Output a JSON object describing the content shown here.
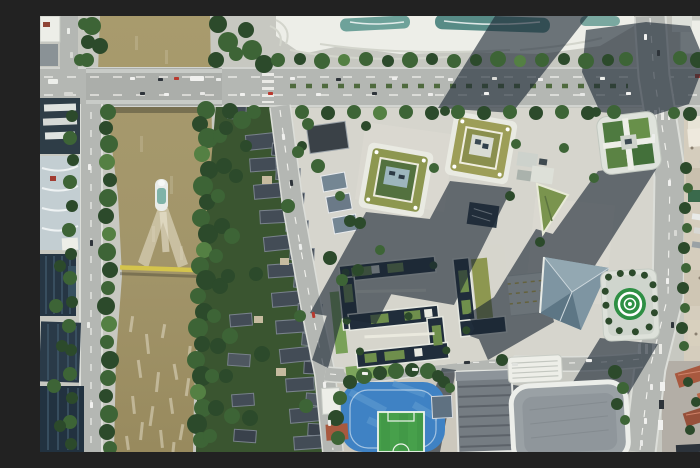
{
  "meta": {
    "domain": "aerial-photograph",
    "description": "Top-down aerial drone photograph of a riverside urban district: a khaki-colored canal on the left with a boat leaving a white V wake, a gray road bridge crossing it at top and a thin yellow footbridge lower down, tree-lined banks, a historic quarter of dark tiled rooftops east of the canal, a wide tree-lined boulevard across the top, modern square office towers with olive-green roof gardens casting long diagonal shadows to the southwest, a glass pyramid hall, a rooftop circular green helipad, a zigzag dark-glass low-rise complex, a blue running track with green soccer pitch at bottom center, large gray-roofed halls at bottom right, a construction yard along the right edge and red-roofed housing in the southeast corner.",
    "width_px": 700,
    "height_px": 436,
    "visible_text": "none"
  },
  "landmarks": [
    {
      "name": "canal",
      "note": "khaki-brown water, choppy white texture at bottom"
    },
    {
      "name": "boat-with-wake",
      "note": "small white boat heading north, V-shaped foam wake"
    },
    {
      "name": "road-bridge",
      "note": "gray multi-lane bridge with vehicles"
    },
    {
      "name": "yellow-footbridge",
      "note": "thin yellow span across canal"
    },
    {
      "name": "historic-rooftop-quarter",
      "note": "rows of dark gabled tile roofs among trees"
    },
    {
      "name": "top-boulevard",
      "note": "wide east-west avenue with tree rows and traffic"
    },
    {
      "name": "green-roof-towers",
      "note": "three square towers with olive roof gardens"
    },
    {
      "name": "glass-pyramid",
      "note": "triangular glass-roofed hall"
    },
    {
      "name": "helipad-tower",
      "note": "circular green helipad with white rings"
    },
    {
      "name": "sports-field",
      "note": "blue running track around green soccer pitch"
    },
    {
      "name": "construction-yard",
      "note": "tan ground, sheds, parked trucks"
    },
    {
      "name": "red-roof-housing",
      "note": "terracotta gabled roofs, southeast corner"
    }
  ],
  "palette": {
    "ground": "#c7c8c1",
    "plaza": "#d6d5cd",
    "road": "#b4b7b3",
    "bridge_deck": "#abaeaa",
    "river_top": "#a89b6d",
    "river_bottom": "#97895c",
    "wake": "#efe9d8",
    "tree_dark": "#2c4a2b",
    "tree_mid": "#3d6436",
    "tree_light": "#548043",
    "historic_base": "#3a5530",
    "historic_roof": "#434c56",
    "historic_ridge": "#79828c",
    "navy": "#202d3b",
    "navy_building": "#263644",
    "white_bldg": "#edeee8",
    "tower_white": "#e9eae2",
    "roof_olive": "#8d9750",
    "roof_olive2": "#9d9e58",
    "court_green": "#53713f",
    "glass_teal": "#6ea29a",
    "glass_blue": "#7e95a2",
    "shadow": "#1b2633",
    "track_blue": "#3f82c4",
    "track_blue_light": "#639fd1",
    "pitch": "#47a04b",
    "construction": "#d5cdbd",
    "red_roof": "#a8593f",
    "red_roof_light": "#b9684a",
    "heli_green": "#2e8f44",
    "bridge_yellow": "#d4c44c",
    "car_white": "#f1f1ef",
    "car_dark": "#2e343a",
    "car_red": "#b8392e",
    "residential_ground": "#b3aea6"
  }
}
